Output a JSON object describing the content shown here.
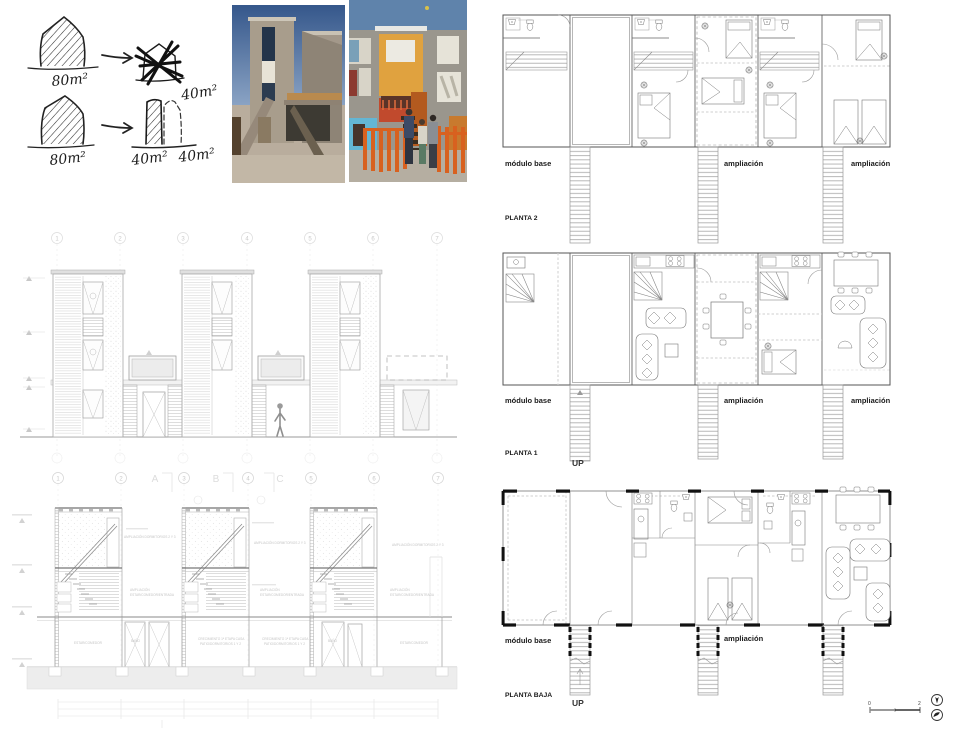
{
  "sketch": {
    "house_large_1": "80m²",
    "house_small_crossed": "40m²",
    "house_large_2": "80m²",
    "tower_small_1": "40m²",
    "tower_small_2": "40m²"
  },
  "elevation": {
    "grid": [
      "1",
      "2",
      "3",
      "4",
      "5",
      "6",
      "7"
    ]
  },
  "section": {
    "grid": [
      "1",
      "2",
      "3",
      "4",
      "5",
      "6",
      "7"
    ],
    "letters": [
      "A",
      "B",
      "C"
    ],
    "annotations": {
      "upper": "AMPLIACIÓN DORMITORIOS 2 Y 3",
      "mid1": "AMPLIACIÓN",
      "mid2": "ESTAR/COMEDOR/ENTRADA",
      "living": "ESTAR/COMEDOR",
      "bath": "BAÑO",
      "growth1": "CRECIMIENTO 1ª ETAPA CASA",
      "growth2": "PATIO/DORMITORIOS 1 Y 2"
    }
  },
  "plans": {
    "planta2": {
      "title": "PLANTA 2",
      "module": "módulo base",
      "amp1": "ampliación",
      "amp2": "ampliación"
    },
    "planta1": {
      "title": "PLANTA 1",
      "module": "módulo base",
      "amp1": "ampliación",
      "amp2": "ampliación",
      "up": "UP"
    },
    "plantabaja": {
      "title": "PLANTA BAJA",
      "module": "módulo base",
      "amp1": "ampliación",
      "up": "UP"
    }
  },
  "scalebar": {
    "zero": "0",
    "two": "2"
  },
  "colors": {
    "sky": "#47659a",
    "concrete": "#a59a89",
    "orange_panel": "#e0a23f",
    "red_balcony": "#c14a2d",
    "blue_wall": "#64b6d4",
    "fence_orange": "#d8611f",
    "ink": "#1a1a1a",
    "drawing_gray": "#9a9a9a",
    "faint_gray": "#d8d8d8"
  }
}
